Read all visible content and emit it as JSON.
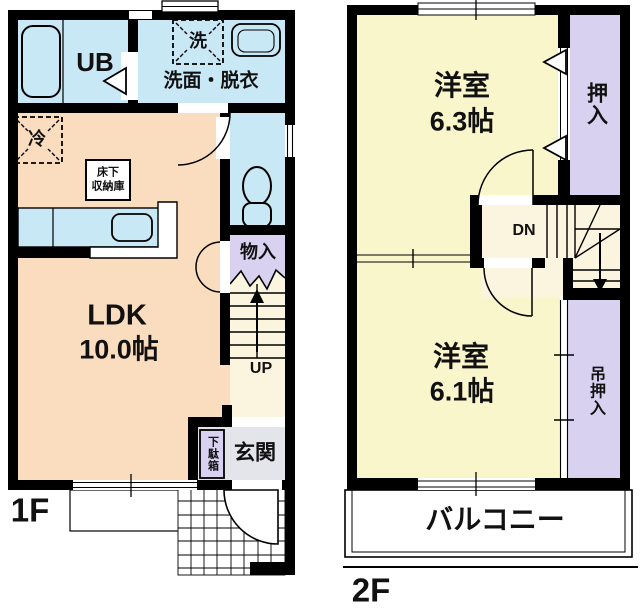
{
  "palette": {
    "wall": "#000000",
    "ldk": "#FADDBF",
    "wet": "#C9E8F6",
    "room": "#FAF6CC",
    "hall": "#FBF4DE",
    "closet": "#D8D2F0",
    "genkan": "#E4E4EB",
    "white": "#FFFFFF"
  },
  "floor1": {
    "label": "1F",
    "unit_bath": "UB",
    "washer": "洗",
    "washroom": "洗面・脱衣",
    "fridge": "冷",
    "underfloor_line1": "床下",
    "underfloor_line2": "収納庫",
    "ldk_name": "LDK",
    "ldk_area": "10.0帖",
    "storage": "物入",
    "stair_up": "UP",
    "entrance": "玄関",
    "shoe_cabinet": "下駄箱"
  },
  "floor2": {
    "label": "2F",
    "room_a_name": "洋室",
    "room_a_area": "6.3帖",
    "closet_a": "押入",
    "stair_down": "DN",
    "room_b_name": "洋室",
    "room_b_area": "6.1帖",
    "closet_b": "吊押入",
    "balcony": "バルコニー"
  }
}
